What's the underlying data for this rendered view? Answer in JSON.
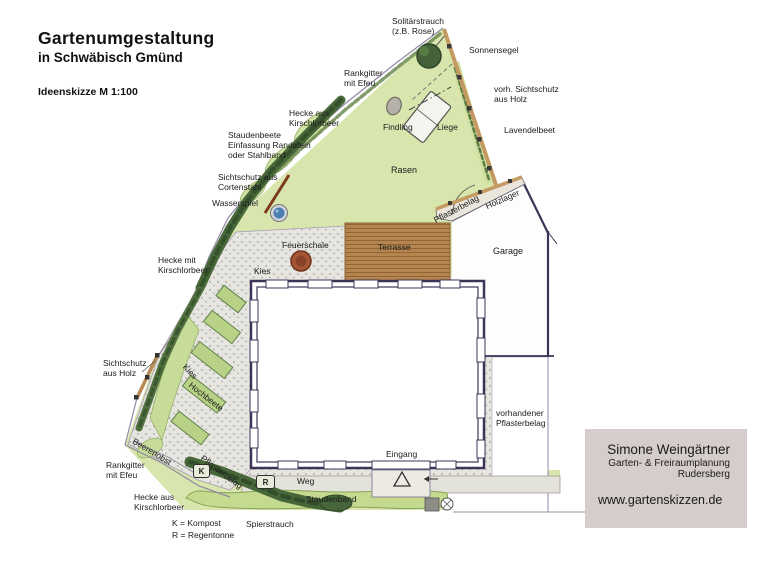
{
  "header": {
    "title": "Gartenumgestaltung",
    "subtitle": "in Schwäbisch Gmünd",
    "scale_note": "Ideenskizze M 1:100"
  },
  "plan_labels": {
    "solitaerstrauch": "Solitärstrauch\n(z.B. Rose)",
    "sonnensegel": "Sonnensegel",
    "rankgitter_top": "Rankgitter\nmit Efeu",
    "vorh_sichtschutz": "vorh. Sichtschutz\naus Holz",
    "hecke_kirschlorbeer_top": "Hecke aus\nKirschlorbeer",
    "findling": "Findling",
    "liege": "Liege",
    "lavendelbeet": "Lavendelbeet",
    "staudenbeete": "Staudenbeete\nEinfassung Randstein\noder Stahlband",
    "sichtschutz_cortenstahl": "Sichtschutz aus\nCortenstahl",
    "rasen": "Rasen",
    "wasserspiel": "Wasserspiel",
    "pflasterbelag_upper": "Pflasterbelag",
    "holzlager": "Holzlager",
    "feuerschale": "Feuerschale",
    "terrasse": "Terrasse",
    "garage": "Garage",
    "hecke_kirschlorbeer_mid": "Hecke mit\nKirschlorbeer",
    "kies_upper": "Kies",
    "sichtschutz_holz_left": "Sichtschutz\naus Holz",
    "kies_left": "Kies",
    "hochbeete": "Hochbeete",
    "vorh_pflasterbelag": "vorhandener\nPflasterbelag",
    "beerenobst": "Beerenobst",
    "rankgitter_bottom": "Rankgitter\nmit Efeu",
    "pflasterbelag_lower": "Pflasterbelag",
    "eingang": "Eingang",
    "weg": "Weg",
    "hecke_kirschlorbeer_bottom": "Hecke aus\nKirschlorbeer",
    "staudenband": "Staudenband",
    "spierstrauch": "Spierstrauch"
  },
  "symbols": {
    "kompost_abbr": "K",
    "regentonne_abbr": "R"
  },
  "legend": {
    "kompost": "K = Kompost",
    "regentonne": "R = Regentonne"
  },
  "business_card": {
    "name": "Simone Weingärtner",
    "profession": "Garten- & Freiraumplanung",
    "location": "Rudersberg",
    "website": "www.gartenskizzen.de"
  },
  "colors": {
    "lawn": "#d8e5ad",
    "hedge_dark": "#47663a",
    "bed_green": "#c8dc9a",
    "gravel": "#e6e5e0",
    "terrace_wood": "#b5854f",
    "wall": "#3d3457",
    "fence_wood": "#c49a62",
    "corten": "#7c3c1e",
    "water": "#4d7fb3",
    "fire_bowl": "#a65635",
    "card_bg": "#d5cdcc"
  }
}
